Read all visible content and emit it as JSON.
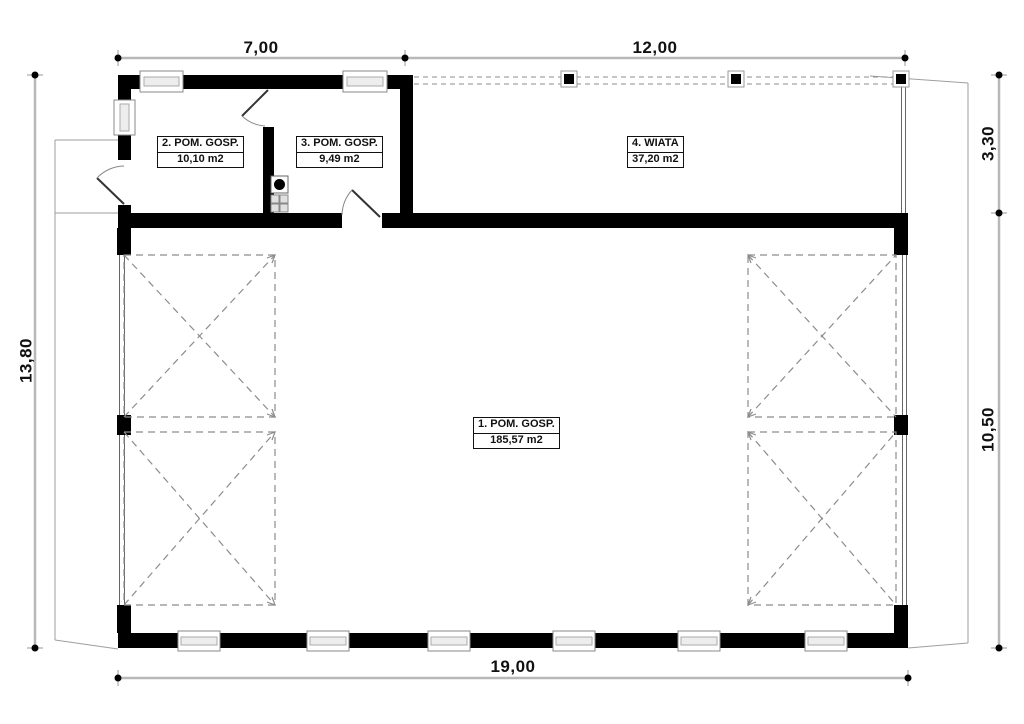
{
  "plan": {
    "type": "architectural-floor-plan",
    "rooms": {
      "room1": {
        "label": "1. POM. GOSP.",
        "area": "185,57 m2"
      },
      "room2": {
        "label": "2. POM. GOSP.",
        "area": "10,10 m2"
      },
      "room3": {
        "label": "3. POM. GOSP.",
        "area": "9,49 m2"
      },
      "room4": {
        "label": "4. WIATA",
        "area": "37,20 m2"
      }
    },
    "dimensions": {
      "top_left": "7,00",
      "top_right": "12,00",
      "left": "13,80",
      "right_top": "3,30",
      "right_bottom": "10,50",
      "bottom": "19,00"
    },
    "colors": {
      "wall": "#000000",
      "dimension_line": "#b8b8b8",
      "dashed_line": "#8c8c8c",
      "apron_outline": "#9e9e9e",
      "background": "#ffffff"
    }
  }
}
